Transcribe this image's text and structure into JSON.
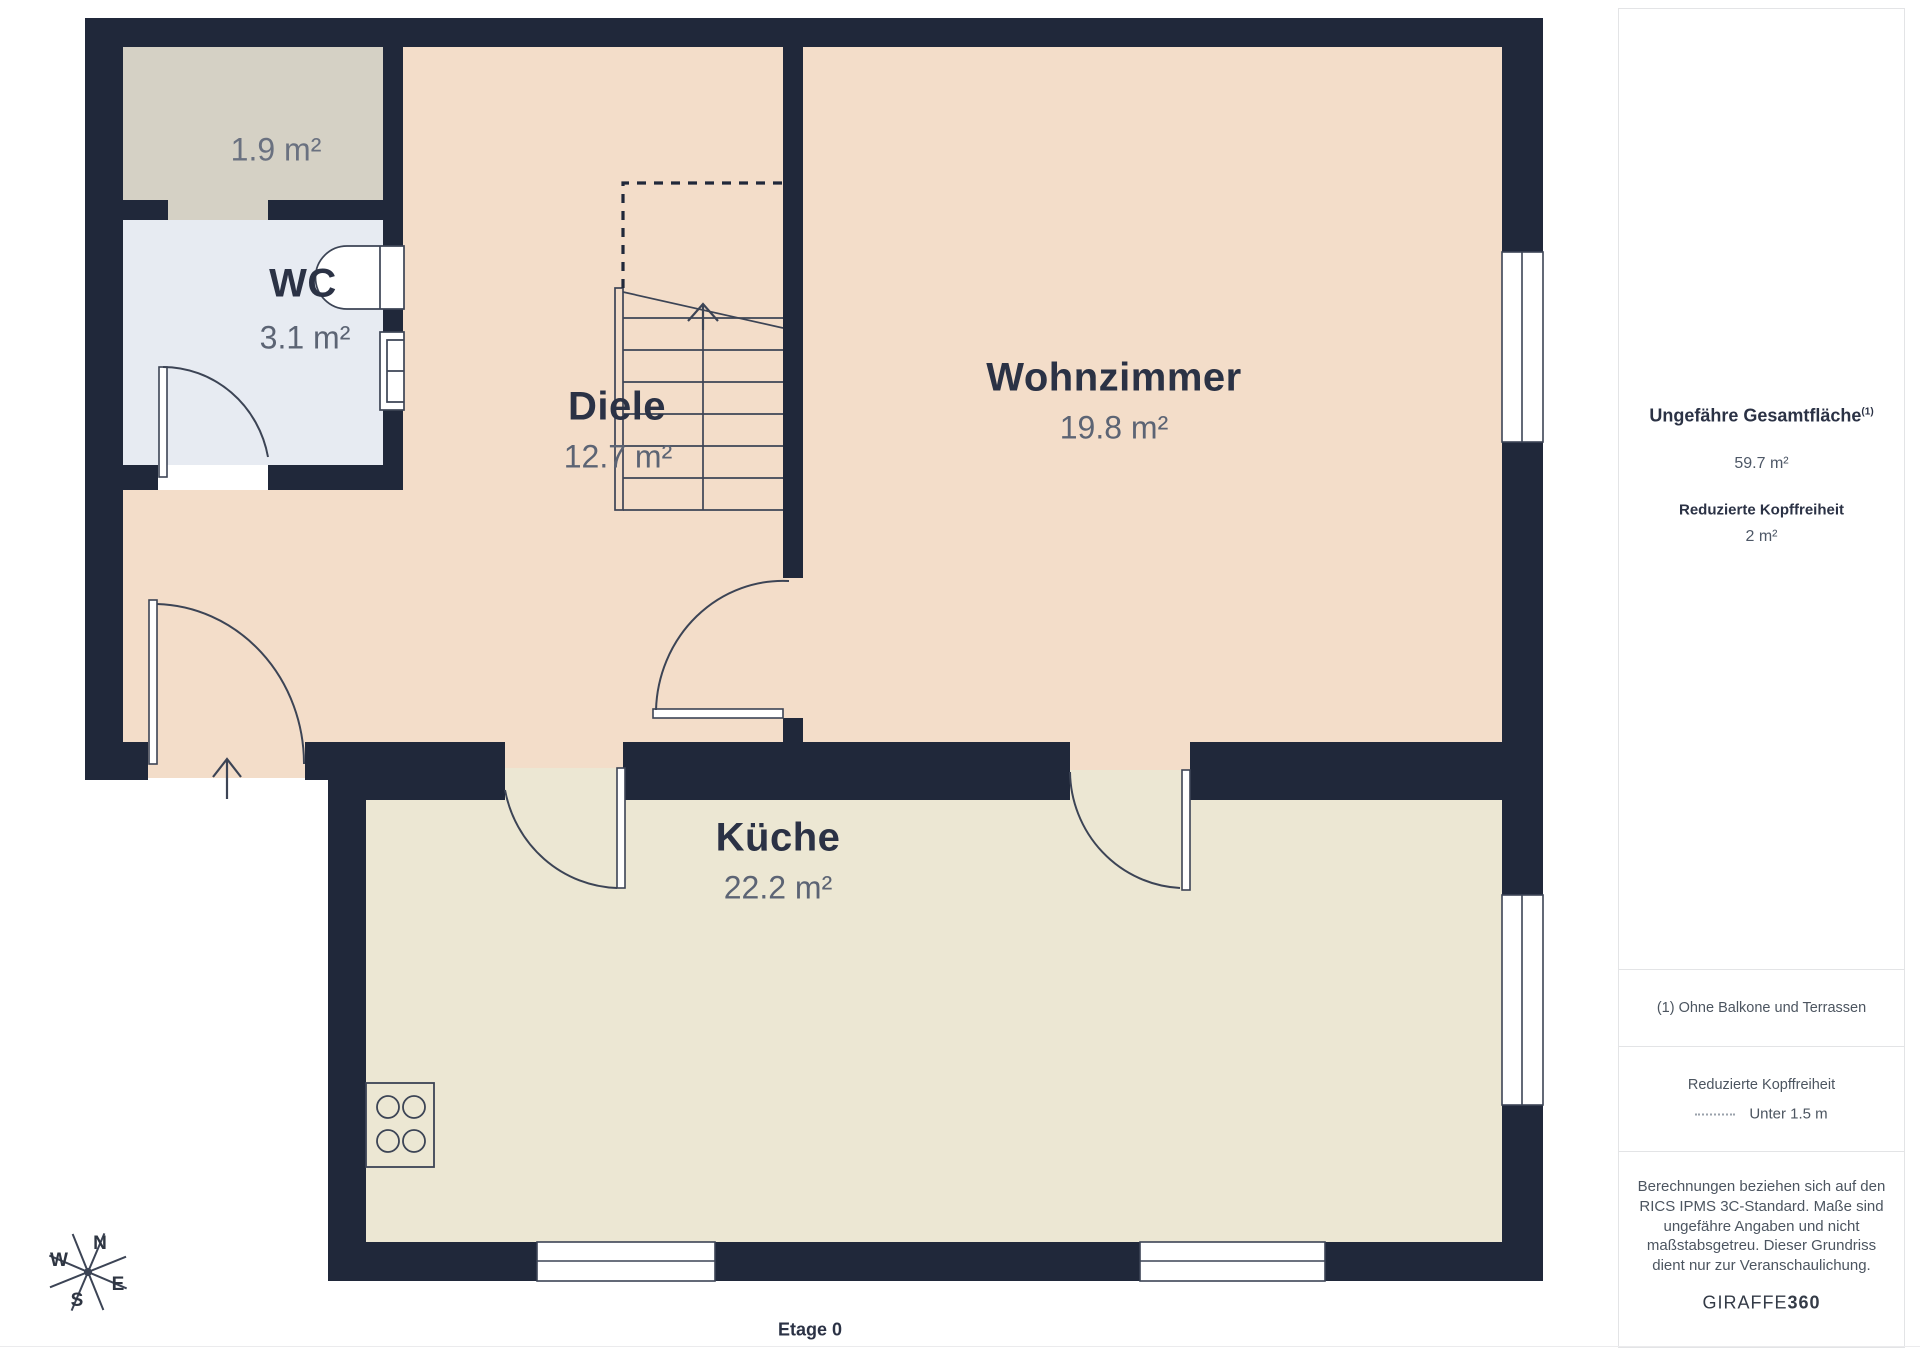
{
  "colors": {
    "wall": "#20283a",
    "floor_tan": "#f3ddc9",
    "floor_cream": "#ece7d3",
    "floor_wc": "#e7ebf2",
    "floor_storage": "#d5d1c5",
    "stroke": "#3c4455",
    "label": "#2b3245",
    "area_text": "#5c6474"
  },
  "plan": {
    "floor_label": "Etage 0",
    "rooms": {
      "storage": {
        "area": "1.9 m²"
      },
      "wc": {
        "name": "WC",
        "area": "3.1 m²"
      },
      "diele": {
        "name": "Diele",
        "area": "12.7 m²"
      },
      "wohnzimmer": {
        "name": "Wohnzimmer",
        "area": "19.8 m²"
      },
      "kueche": {
        "name": "Küche",
        "area": "22.2 m²"
      }
    },
    "compass": {
      "n": "N",
      "e": "E",
      "s": "S",
      "w": "W"
    }
  },
  "sidebar": {
    "total_area_label": "Ungefähre Gesamtfläche",
    "total_area_sup": "(1)",
    "total_area_value": "59.7 m²",
    "reduced_headroom_label": "Reduzierte Kopffreiheit",
    "reduced_headroom_value": "2 m²",
    "footnote": "(1) Ohne Balkone und Terrassen",
    "legend_title": "Reduzierte Kopffreiheit",
    "legend_value": "Unter 1.5 m",
    "disclaimer": "Berechnungen beziehen sich auf den RICS IPMS 3C-Standard. Maße sind ungefähre Angaben und nicht maßstabsgetreu. Dieser Grundriss dient nur zur Veranschaulichung.",
    "brand_name": "GIRAFFE",
    "brand_number": "360"
  }
}
